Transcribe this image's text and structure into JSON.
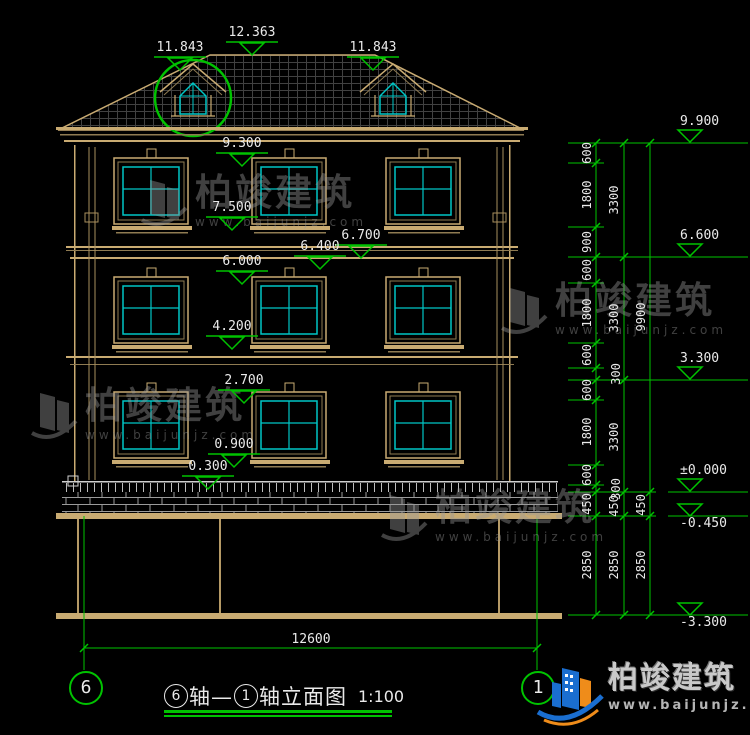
{
  "brand": {
    "cn": "柏竣建筑",
    "url": "www.baijunjz.com"
  },
  "title_block": {
    "axis_a": "6",
    "sep": "轴—",
    "axis_b": "1",
    "suffix": "轴立面图",
    "scale": "1:100"
  },
  "axis_bubbles": {
    "left": "6",
    "right": "1"
  },
  "bottom_dim": {
    "value": "12600"
  },
  "colors": {
    "dim_green": "#00c300",
    "building_tan": "#c9ab72",
    "window_cyan": "#00c6c6",
    "text_white": "#eaeaea"
  },
  "left_markers": [
    {
      "text": "12.363",
      "x": 252,
      "y": 33
    },
    {
      "text": "11.843",
      "x": 180,
      "y": 48
    },
    {
      "text": "11.843",
      "x": 373,
      "y": 48
    },
    {
      "text": "9.300",
      "x": 242,
      "y": 144
    },
    {
      "text": "7.500",
      "x": 232,
      "y": 208
    },
    {
      "text": "6.700",
      "x": 361,
      "y": 236
    },
    {
      "text": "6.400",
      "x": 320,
      "y": 247
    },
    {
      "text": "6.000",
      "x": 242,
      "y": 262
    },
    {
      "text": "4.200",
      "x": 232,
      "y": 327
    },
    {
      "text": "2.700",
      "x": 244,
      "y": 381
    },
    {
      "text": "0.900",
      "x": 234,
      "y": 445
    },
    {
      "text": "0.300",
      "x": 208,
      "y": 467
    }
  ],
  "right_levels": [
    {
      "text": "9.900",
      "y": 143,
      "neg": false
    },
    {
      "text": "6.600",
      "y": 257,
      "neg": false
    },
    {
      "text": "3.300",
      "y": 380,
      "neg": false
    },
    {
      "text": "±0.000",
      "y": 492,
      "neg": false
    },
    {
      "text": "-0.450",
      "y": 516,
      "neg": true
    },
    {
      "text": "-3.300",
      "y": 615,
      "neg": true
    }
  ],
  "right_dims": [
    {
      "v": "600",
      "x": 587,
      "y": 153
    },
    {
      "v": "1800",
      "x": 587,
      "y": 195
    },
    {
      "v": "900",
      "x": 587,
      "y": 242
    },
    {
      "v": "600",
      "x": 587,
      "y": 270
    },
    {
      "v": "1800",
      "x": 587,
      "y": 313
    },
    {
      "v": "600",
      "x": 587,
      "y": 355
    },
    {
      "v": "600",
      "x": 587,
      "y": 390
    },
    {
      "v": "1800",
      "x": 587,
      "y": 432
    },
    {
      "v": "600",
      "x": 587,
      "y": 475
    },
    {
      "v": "450",
      "x": 587,
      "y": 504
    },
    {
      "v": "2850",
      "x": 587,
      "y": 565
    },
    {
      "v": "3300",
      "x": 614,
      "y": 200
    },
    {
      "v": "3300",
      "x": 614,
      "y": 318
    },
    {
      "v": "300",
      "x": 616,
      "y": 374
    },
    {
      "v": "3300",
      "x": 614,
      "y": 437
    },
    {
      "v": "300",
      "x": 616,
      "y": 489
    },
    {
      "v": "450",
      "x": 614,
      "y": 506
    },
    {
      "v": "2850",
      "x": 614,
      "y": 565
    },
    {
      "v": "9900",
      "x": 641,
      "y": 317
    },
    {
      "v": "450",
      "x": 641,
      "y": 505
    },
    {
      "v": "2850",
      "x": 641,
      "y": 565
    }
  ],
  "watermarks": [
    {
      "x": 138,
      "y": 172
    },
    {
      "x": 28,
      "y": 385
    },
    {
      "x": 498,
      "y": 280
    },
    {
      "x": 378,
      "y": 487
    }
  ]
}
